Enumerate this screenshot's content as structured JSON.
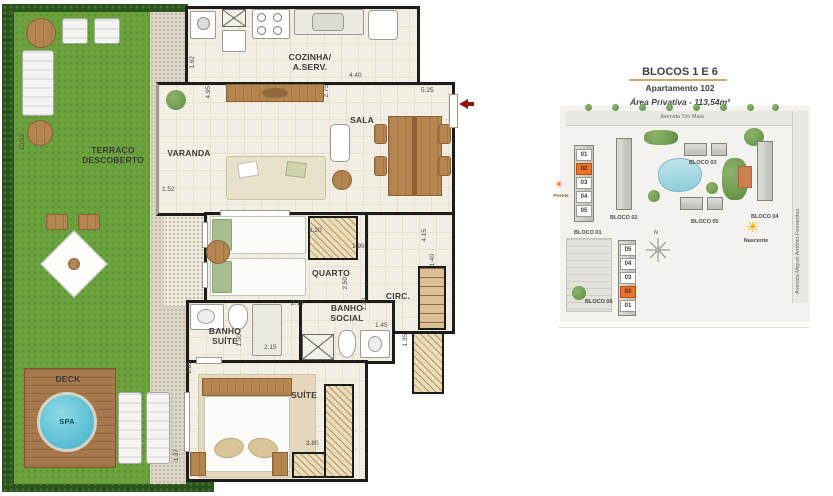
{
  "floorplan": {
    "rooms": {
      "terraco": "TERRAÇO\nDESCOBERTO",
      "varanda": "VARANDA",
      "cozinha": "COZINHA/\nA.SERV.",
      "sala": "SALA",
      "quarto": "QUARTO",
      "circ": "CIRC.",
      "banho_suite": "BANHO\nSUÍTE",
      "banho_social": "BANHO\nSOCIAL",
      "suite": "SUÍTE",
      "deck": "DECK",
      "spa": "SPA"
    },
    "dims": {
      "terraco_h": "10.52",
      "terraco_edge": "1.52",
      "cozinha_left": "1.62",
      "cozinha_w": "4.40",
      "varanda_h": "4.95",
      "sala_left": "2.75",
      "sala_w": "5.25",
      "quarto_w": "3.20",
      "quarto_right": "1.95",
      "quarto_h": "2.50",
      "circ_h": "4.15",
      "closet_w": "1.40",
      "social_w": "2.15",
      "social_h": "1.30",
      "circ_w": "1.45",
      "closet2_h": "1.35",
      "bsuite_h": "1.50",
      "bsuite_w": "2.15",
      "suite_top": "2.85",
      "suite_w": "3.80",
      "suite_left": "1.37"
    }
  },
  "sitemap": {
    "title": "BLOCOS 1 E 6",
    "subtitle": "Apartamento 102",
    "area": "Área Privativa - 113,54m²",
    "street_top": "Avenida Tim Maia",
    "street_right": "Avenida Miguel Antônio Fernandes",
    "blocks": {
      "b1": "BLOCO 01",
      "b2": "BLOCO 02",
      "b3": "BLOCO 03",
      "b4": "BLOCO 04",
      "b5": "BLOCO 05",
      "b6": "BLOCO 06"
    },
    "bloco1_units": [
      "01",
      "02",
      "03",
      "04",
      "05"
    ],
    "bloco6_units": [
      "05",
      "04",
      "03",
      "02",
      "01"
    ],
    "highlighted_unit": "02",
    "sun_west": "Poente",
    "sun_east": "Nascente",
    "sun_glyph": "☀",
    "compass": "N"
  },
  "colors": {
    "highlight": "#e8742c",
    "grass": "#6ca23e",
    "spa_water": "#52bfd4",
    "wall": "#1d1d1b",
    "wood": "#b5854f",
    "title_rule": "#c9a96e",
    "sun_east": "#f0b400",
    "sun_west": "#e8742c"
  }
}
